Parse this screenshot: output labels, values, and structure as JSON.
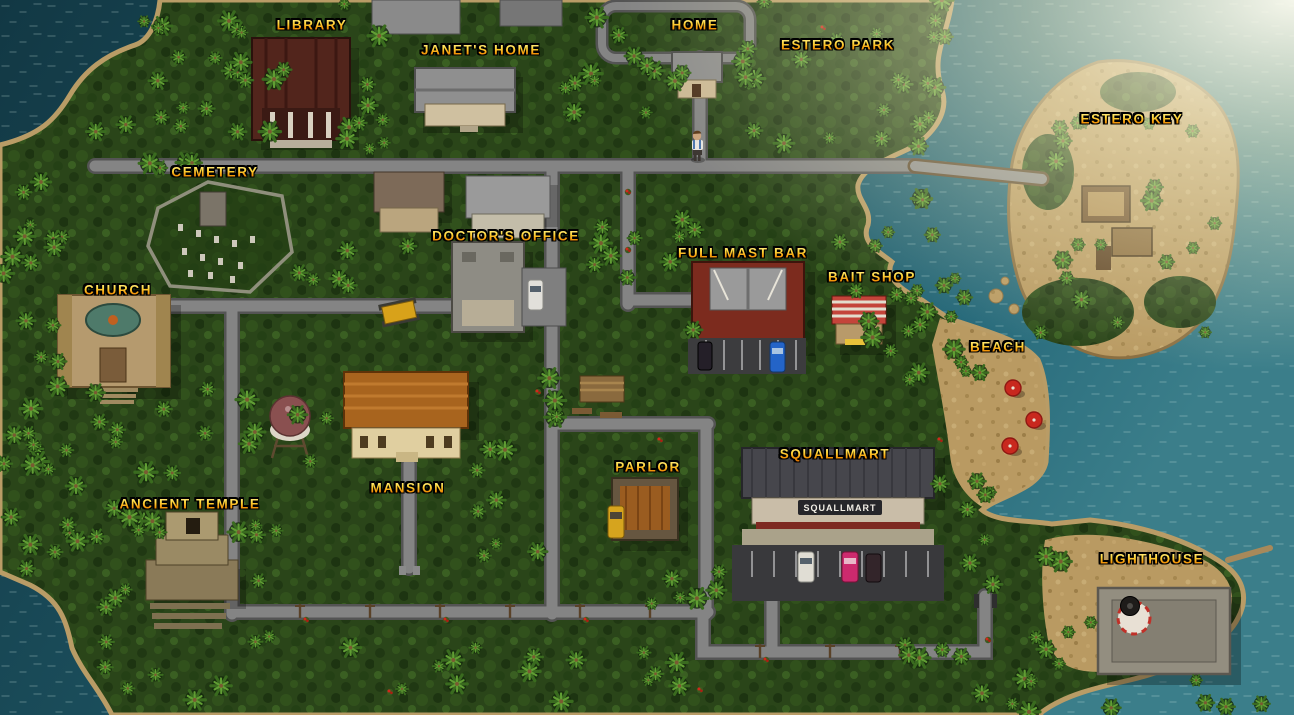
{
  "locations": [
    {
      "id": "library",
      "label": "LIBRARY",
      "x": 312,
      "y": 25
    },
    {
      "id": "janets-home",
      "label": "JANET'S HOME",
      "x": 481,
      "y": 50
    },
    {
      "id": "home",
      "label": "HOME",
      "x": 695,
      "y": 25
    },
    {
      "id": "estero-park",
      "label": "ESTERO PARK",
      "x": 838,
      "y": 45
    },
    {
      "id": "estero-key",
      "label": "ESTERO KEY",
      "x": 1132,
      "y": 119
    },
    {
      "id": "cemetery",
      "label": "CEMETERY",
      "x": 215,
      "y": 172
    },
    {
      "id": "doctors-office",
      "label": "DOCTOR'S OFFICE",
      "x": 506,
      "y": 236
    },
    {
      "id": "full-mast-bar",
      "label": "FULL MAST BAR",
      "x": 743,
      "y": 253
    },
    {
      "id": "bait-shop",
      "label": "BAIT SHOP",
      "x": 872,
      "y": 277
    },
    {
      "id": "church",
      "label": "CHURCH",
      "x": 118,
      "y": 290
    },
    {
      "id": "beach",
      "label": "BEACH",
      "x": 998,
      "y": 347
    },
    {
      "id": "mansion",
      "label": "MANSION",
      "x": 408,
      "y": 488
    },
    {
      "id": "parlor",
      "label": "PARLOR",
      "x": 648,
      "y": 467
    },
    {
      "id": "squallmart",
      "label": "SQUALLMART",
      "x": 835,
      "y": 454
    },
    {
      "id": "ancient-temple",
      "label": "ANCIENT TEMPLE",
      "x": 190,
      "y": 504
    },
    {
      "id": "lighthouse",
      "label": "LIGHTHOUSE",
      "x": 1152,
      "y": 559
    }
  ],
  "player": {
    "x": 697,
    "y": 148
  },
  "signs": {
    "squallmart_storefront": "SQUALLMART"
  },
  "palette": {
    "label_gold_top": "#ffd93e",
    "label_gold_bottom": "#d96d00",
    "ocean_deep": "#133c49",
    "ocean_mid": "#1f5b68",
    "sun_glare": "#fdf8df",
    "jungle_green": "#2a4519",
    "sand": "#c2a169",
    "road_gray": "#848484",
    "umbrella_red": "#c8281e"
  }
}
